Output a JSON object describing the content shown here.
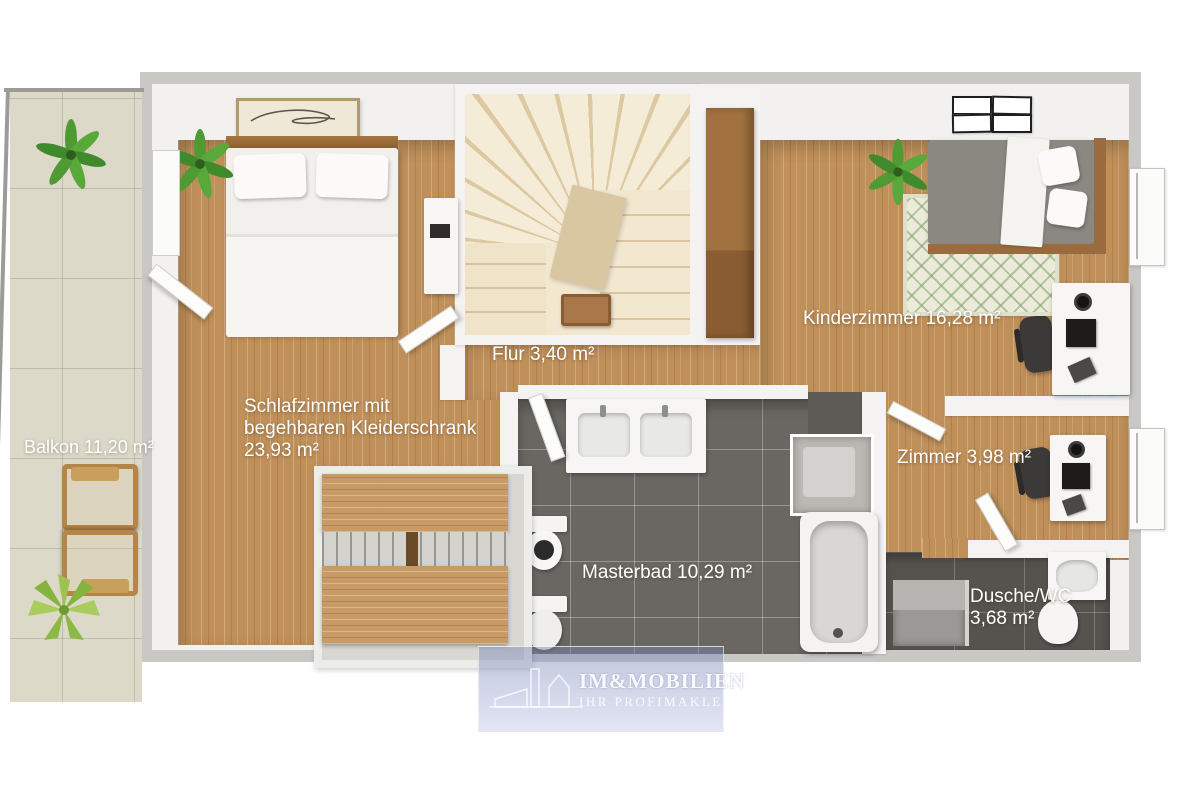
{
  "rooms": [
    {
      "id": "balkon",
      "name": "Balkon",
      "area": "11,20 m²",
      "lines": [
        "Balkon 11,20 m²"
      ]
    },
    {
      "id": "schlafzimmer",
      "name": "Schlafzimmer mit begehbaren Kleiderschrank",
      "area": "23,93 m²",
      "lines": [
        "Schlafzimmer mit",
        "begehbaren Kleiderschrank",
        "23,93 m²"
      ]
    },
    {
      "id": "flur",
      "name": "Flur",
      "area": "3,40 m²",
      "lines": [
        "Flur 3,40 m²"
      ]
    },
    {
      "id": "kinderzimmer",
      "name": "Kinderzimmer",
      "area": "16,28 m²",
      "lines": [
        "Kinderzimmer 16,28 m²"
      ]
    },
    {
      "id": "zimmer",
      "name": "Zimmer",
      "area": "3,98 m²",
      "lines": [
        "Zimmer 3,98 m²"
      ]
    },
    {
      "id": "masterbad",
      "name": "Masterbad",
      "area": "10,29 m²",
      "lines": [
        "Masterbad 10,29 m²"
      ]
    },
    {
      "id": "dusche_wc",
      "name": "Dusche/WC",
      "area": "3,68 m²",
      "lines": [
        "Dusche/WC",
        "3,68 m²"
      ]
    }
  ],
  "watermark": {
    "brand": "IM&MOBILIEN",
    "tagline": "IHR PROFIMAKLER"
  },
  "colors": {
    "wood_floor": "#c0905a",
    "bath_tile": "#6a6762",
    "shower_tile": "#56534e",
    "balcony_tile": "#dcd9c9",
    "rug_green": "#8fb27c",
    "stairs_cream": "#f2e7cf",
    "wall_white": "#f4f3f1",
    "exterior_gray": "#c9c8c5",
    "label_text": "#ffffff",
    "watermark_tint": "#aab1d6"
  }
}
